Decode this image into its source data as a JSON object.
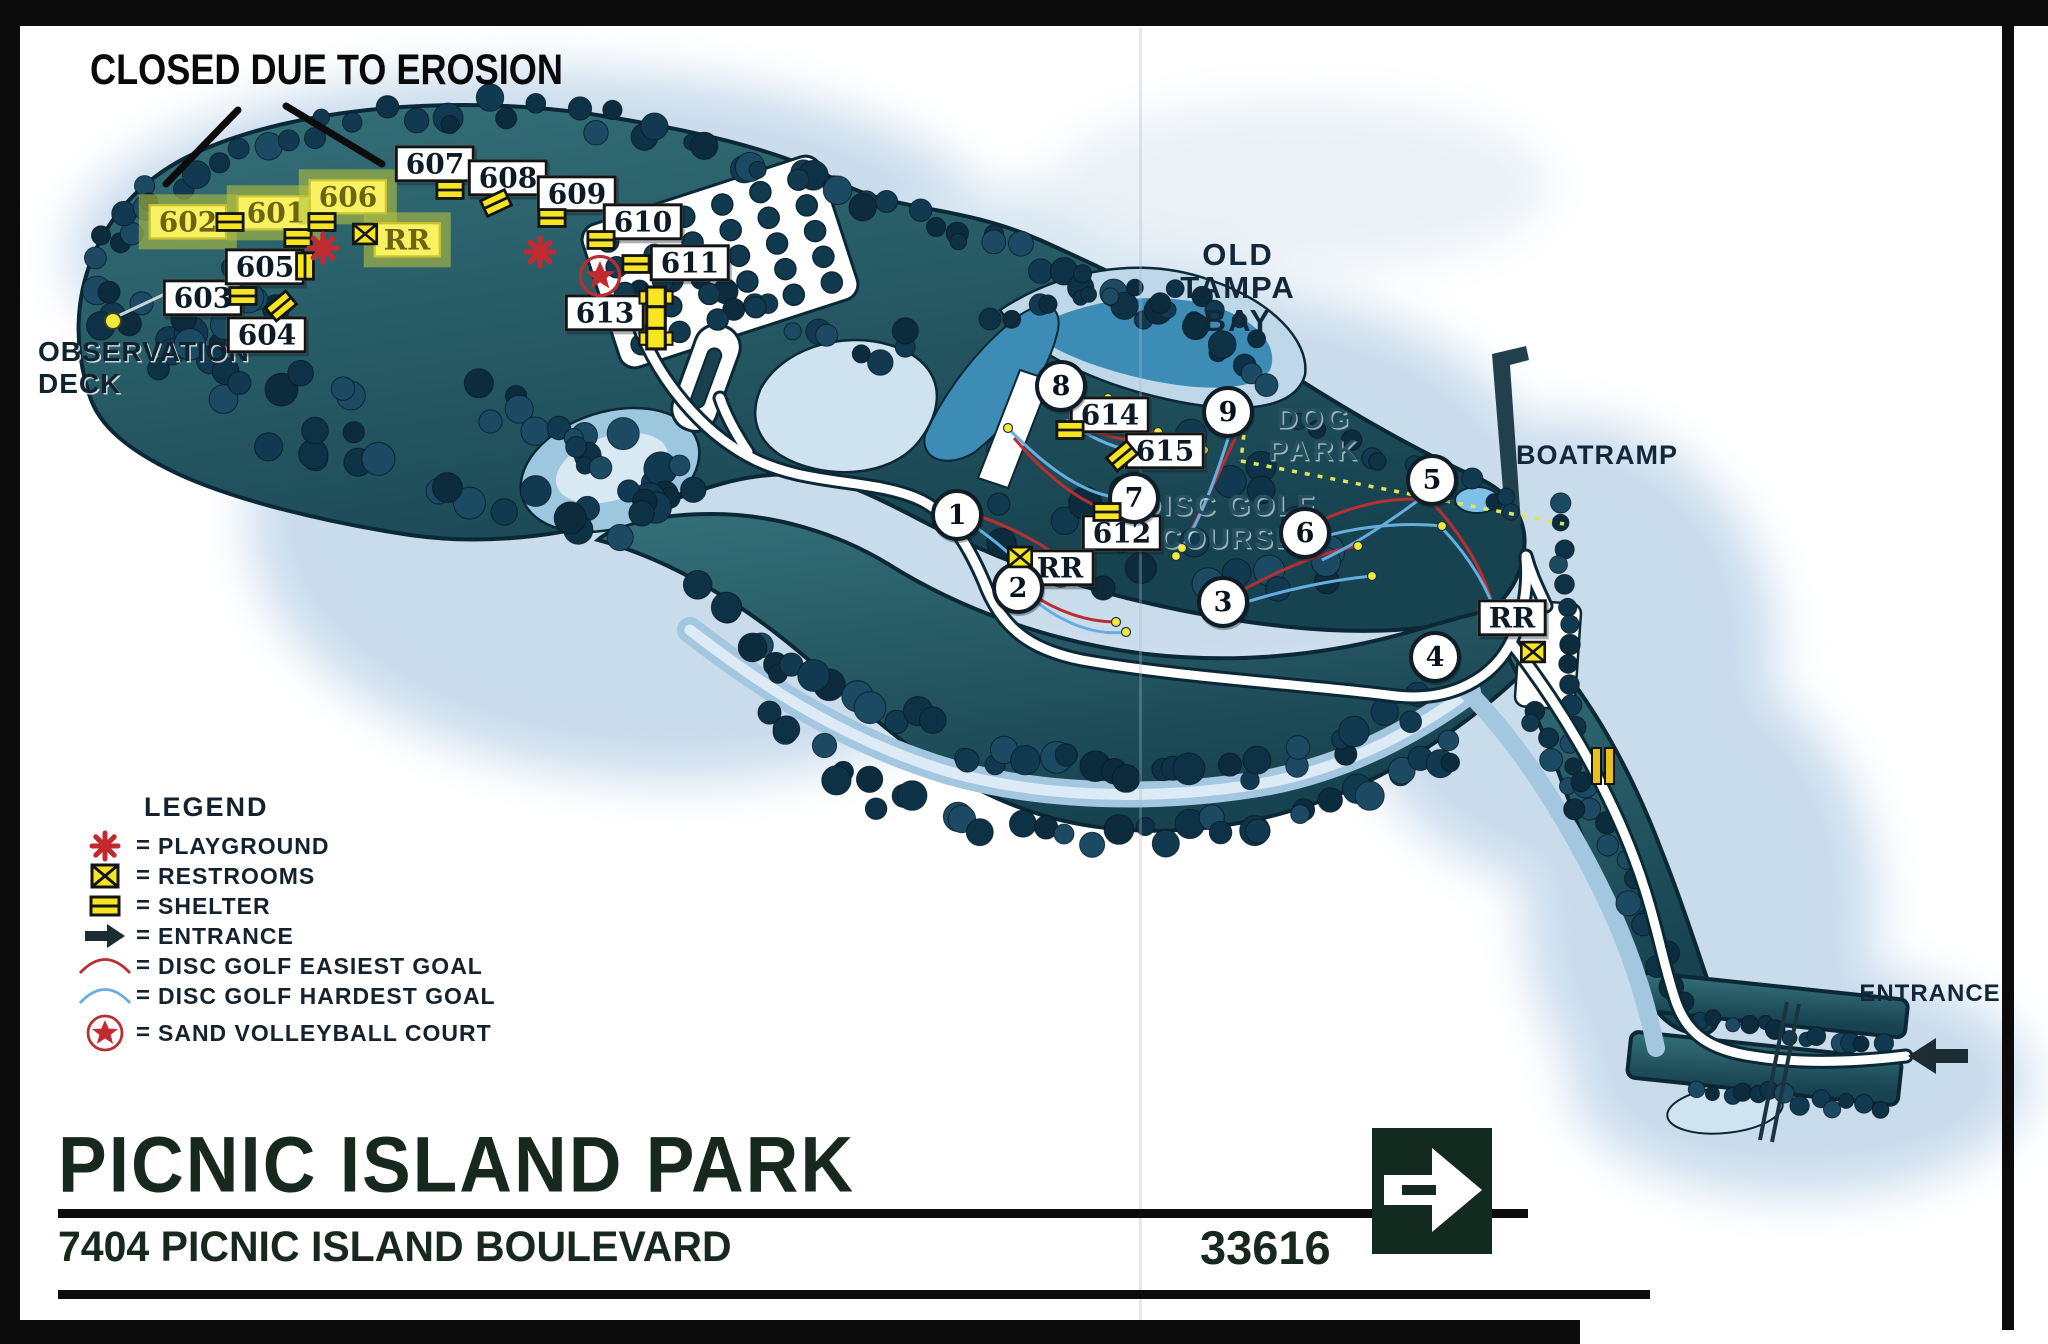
{
  "notice": {
    "text": "CLOSED DUE TO EROSION"
  },
  "map": {
    "areas": {
      "old_tampa_bay": "OLD\nTAMPA\nBAY",
      "dog_park": "DOG\nPARK",
      "disc_golf_course": "DISC GOLF\nCOURSE",
      "boatramp": "BOATRAMP",
      "observation_deck": "OBSERVATION\nDECK",
      "entrance": "ENTRANCE"
    },
    "shelters": [
      {
        "label": "601",
        "x": 276,
        "y": 213,
        "closed": true
      },
      {
        "label": "602",
        "x": 188,
        "y": 222,
        "closed": true
      },
      {
        "label": "603",
        "x": 203,
        "y": 298,
        "closed": false
      },
      {
        "label": "604",
        "x": 267,
        "y": 335,
        "closed": false
      },
      {
        "label": "605",
        "x": 265,
        "y": 267,
        "closed": false
      },
      {
        "label": "606",
        "x": 348,
        "y": 197,
        "closed": true
      },
      {
        "label": "607",
        "x": 435,
        "y": 164,
        "closed": false
      },
      {
        "label": "608",
        "x": 508,
        "y": 178,
        "closed": false
      },
      {
        "label": "609",
        "x": 577,
        "y": 194,
        "closed": false
      },
      {
        "label": "610",
        "x": 643,
        "y": 222,
        "closed": false
      },
      {
        "label": "611",
        "x": 690,
        "y": 263,
        "closed": false
      },
      {
        "label": "612",
        "x": 1122,
        "y": 533,
        "closed": false
      },
      {
        "label": "613",
        "x": 605,
        "y": 313,
        "closed": false
      },
      {
        "label": "614",
        "x": 1110,
        "y": 415,
        "closed": false
      },
      {
        "label": "615",
        "x": 1165,
        "y": 451,
        "closed": false
      }
    ],
    "restroom_labels": [
      {
        "label": "RR",
        "x": 407,
        "y": 240,
        "closed": true
      },
      {
        "label": "RR",
        "x": 1060,
        "y": 568,
        "closed": false
      },
      {
        "label": "RR",
        "x": 1512,
        "y": 618,
        "closed": false
      }
    ],
    "disc_golf_holes": [
      {
        "number": "1",
        "x": 957,
        "y": 515
      },
      {
        "number": "2",
        "x": 1018,
        "y": 588
      },
      {
        "number": "3",
        "x": 1223,
        "y": 602
      },
      {
        "number": "4",
        "x": 1435,
        "y": 657
      },
      {
        "number": "5",
        "x": 1432,
        "y": 480
      },
      {
        "number": "6",
        "x": 1305,
        "y": 533
      },
      {
        "number": "7",
        "x": 1134,
        "y": 498
      },
      {
        "number": "8",
        "x": 1061,
        "y": 386
      },
      {
        "number": "9",
        "x": 1228,
        "y": 412
      }
    ],
    "icons": [
      {
        "type": "shelter-icon",
        "x": 230,
        "y": 222,
        "rot": 0
      },
      {
        "type": "shelter-icon",
        "x": 298,
        "y": 238,
        "rot": 0
      },
      {
        "type": "shelter-icon",
        "x": 322,
        "y": 222,
        "rot": 0
      },
      {
        "type": "shelter-icon",
        "x": 305,
        "y": 266,
        "rot": 90
      },
      {
        "type": "shelter-icon",
        "x": 243,
        "y": 296,
        "rot": 0
      },
      {
        "type": "shelter-icon",
        "x": 281,
        "y": 306,
        "rot": -40
      },
      {
        "type": "shelter-icon",
        "x": 450,
        "y": 190,
        "rot": 0
      },
      {
        "type": "shelter-icon",
        "x": 496,
        "y": 203,
        "rot": -25
      },
      {
        "type": "shelter-icon",
        "x": 552,
        "y": 218,
        "rot": 0
      },
      {
        "type": "shelter-icon",
        "x": 601,
        "y": 240,
        "rot": 0
      },
      {
        "type": "shelter-icon",
        "x": 636,
        "y": 264,
        "rot": 0
      },
      {
        "type": "shelter-icon",
        "x": 1070,
        "y": 430,
        "rot": 0
      },
      {
        "type": "shelter-icon",
        "x": 1122,
        "y": 456,
        "rot": -40
      },
      {
        "type": "shelter-icon",
        "x": 1107,
        "y": 512,
        "rot": 0
      },
      {
        "type": "restrooms-icon",
        "x": 365,
        "y": 234,
        "rot": 0
      },
      {
        "type": "restrooms-icon",
        "x": 1020,
        "y": 557,
        "rot": 0
      },
      {
        "type": "restrooms-icon",
        "x": 1533,
        "y": 652,
        "rot": 0
      },
      {
        "type": "playground-icon",
        "x": 323,
        "y": 248,
        "rot": 0
      },
      {
        "type": "playground-icon",
        "x": 540,
        "y": 252,
        "rot": 0
      },
      {
        "type": "sand-volleyball-icon",
        "x": 600,
        "y": 276,
        "rot": 0
      },
      {
        "type": "shelter-big-icon",
        "x": 656,
        "y": 318,
        "rot": 0
      },
      {
        "type": "shelter-pair-icon",
        "x": 1603,
        "y": 766,
        "rot": 0
      }
    ]
  },
  "legend": {
    "title": "LEGEND",
    "equals": "=",
    "items": [
      {
        "icon": "playground-icon",
        "label": "PLAYGROUND"
      },
      {
        "icon": "restrooms-icon",
        "label": "RESTROOMS"
      },
      {
        "icon": "shelter-icon",
        "label": "SHELTER"
      },
      {
        "icon": "entrance-icon",
        "label": "ENTRANCE"
      },
      {
        "icon": "disc-golf-easiest-icon",
        "label": "DISC GOLF EASIEST GOAL"
      },
      {
        "icon": "disc-golf-hardest-icon",
        "label": "DISC GOLF HARDEST GOAL"
      },
      {
        "icon": "sand-volleyball-icon",
        "label": "SAND VOLLEYBALL COURT"
      }
    ]
  },
  "footer": {
    "title": "PICNIC ISLAND PARK",
    "address": "7404 PICNIC ISLAND BOULEVARD",
    "zip": "33616"
  }
}
